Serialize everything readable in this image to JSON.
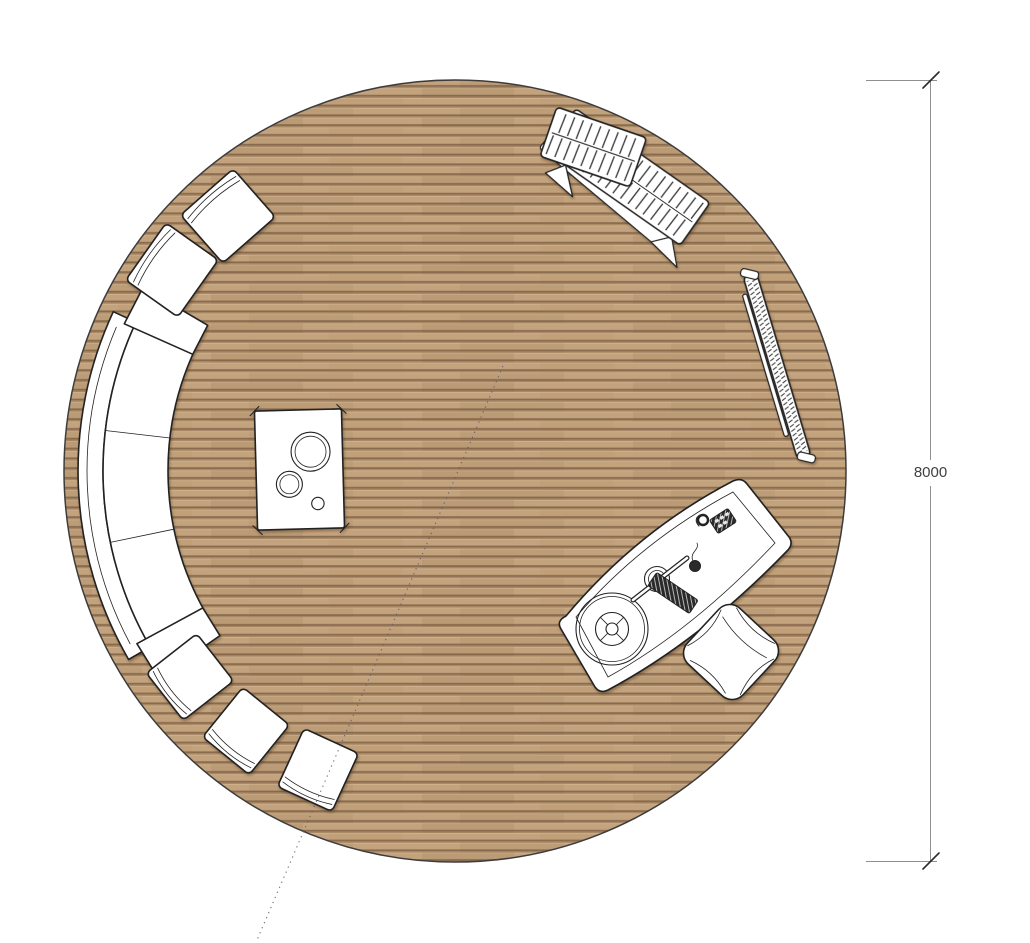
{
  "drawing": {
    "type": "circular floor plan, top view",
    "floor": {
      "shape": "circle",
      "material": "wood deck planks",
      "diameter_mm": 8000
    },
    "dimension": {
      "label": "8000",
      "side": "right",
      "orientation": "vertical"
    },
    "furniture": [
      {
        "name": "sun-lounger",
        "description": "slatted sun lounger, top right"
      },
      {
        "name": "leaning-rack",
        "description": "narrow slatted rack leaning along right edge"
      },
      {
        "name": "curved-desk",
        "description": "curved desk with turntable, lamp, keyboard, mouse and phone"
      },
      {
        "name": "armchair",
        "description": "armchair beside desk, lower right"
      },
      {
        "name": "stove-unit",
        "description": "rectangular stove / cooker with three burners, centre left"
      },
      {
        "name": "curved-sofa",
        "description": "curved three-seat sofa with two armrests along left edge"
      },
      {
        "name": "seat-square",
        "description": "two square lounge seats, upper left"
      },
      {
        "name": "stool-square",
        "description": "three square stools, lower left"
      },
      {
        "name": "dotted-guide-line",
        "description": "dotted reference line from centre to bottom edge"
      }
    ]
  },
  "colors": {
    "background": "#ffffff",
    "plank_light": "#c3a37d",
    "plank_mid": "#a98a67",
    "plank_gap": "#8a6b4e",
    "plank_highlight": "#cfb28c",
    "outline": "#222222",
    "floor_edge": "#3c3c3c",
    "furniture_fill": "#ffffff",
    "detail_line": "#333333",
    "dark_fill": "#2a2a2a",
    "dim_line": "#8f8f8f",
    "dim_tick": "#2b2b2b",
    "dim_text": "#3f3f3f",
    "dotted_line": "#5c5770"
  }
}
